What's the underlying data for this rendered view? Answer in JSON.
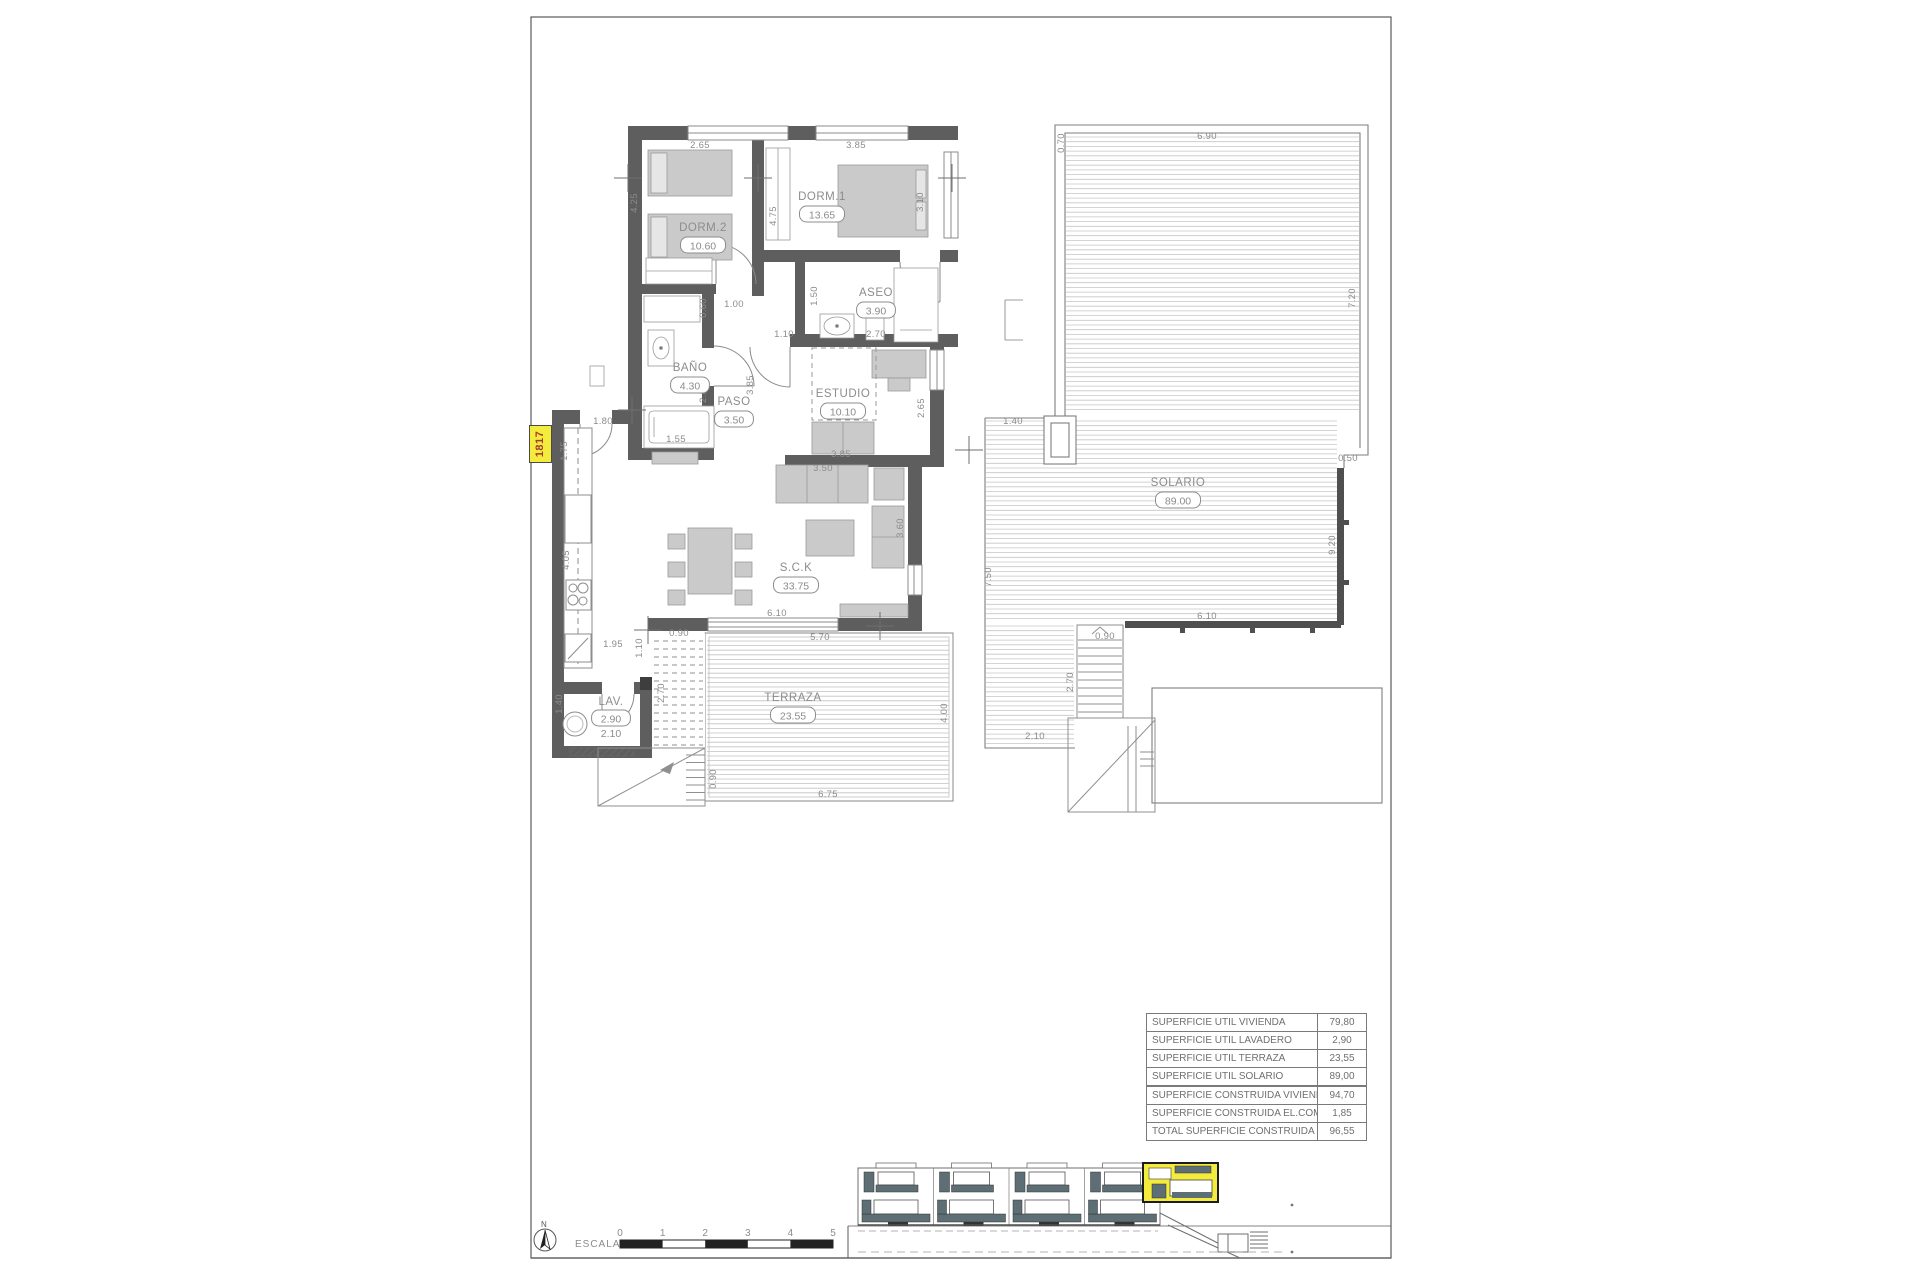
{
  "unit_tag": "1817",
  "colors": {
    "wall": "#5e5e5e",
    "furniture": "#cacaca",
    "deck_line": "#c2c2c2",
    "dim_text": "#8c8c8c",
    "highlight_yellow": "#f3ec3c",
    "tag_text_red": "#a33c2f",
    "railing_slate": "#5d6e74",
    "line_gray": "#7a7a7a"
  },
  "rooms": [
    {
      "name": "DORM.2",
      "area": "10.60",
      "nx": 703,
      "ny": 231,
      "ax": 703,
      "ay": 248
    },
    {
      "name": "DORM.1",
      "area": "13.65",
      "nx": 822,
      "ny": 200,
      "ax": 822,
      "ay": 217
    },
    {
      "name": "ASEO",
      "area": "3.90",
      "nx": 876,
      "ny": 296,
      "ax": 876,
      "ay": 313
    },
    {
      "name": "BAÑO",
      "area": "4.30",
      "nx": 690,
      "ny": 371,
      "ax": 690,
      "ay": 388
    },
    {
      "name": "PASO",
      "area": "3.50",
      "nx": 734,
      "ny": 405,
      "ax": 734,
      "ay": 422
    },
    {
      "name": "ESTUDIO",
      "area": "10.10",
      "nx": 843,
      "ny": 397,
      "ax": 843,
      "ay": 414
    },
    {
      "name": "S.C.K",
      "area": "33.75",
      "nx": 796,
      "ny": 571,
      "ax": 796,
      "ay": 588
    },
    {
      "name": "LAV.",
      "area": "2.90",
      "nx": 611,
      "ny": 705,
      "ax": 611,
      "ay": 721,
      "extra": "2.10",
      "ex": 611,
      "ey": 737
    },
    {
      "name": "TERRAZA",
      "area": "23.55",
      "nx": 793,
      "ny": 701,
      "ax": 793,
      "ay": 718
    },
    {
      "name": "SOLARIO",
      "area": "89.00",
      "nx": 1178,
      "ny": 486,
      "ax": 1178,
      "ay": 503
    }
  ],
  "dims": [
    {
      "t": "2.65",
      "x": 700,
      "y": 148,
      "r": 0
    },
    {
      "t": "3.85",
      "x": 856,
      "y": 148,
      "r": 0
    },
    {
      "t": "4.25",
      "x": 637,
      "y": 203,
      "r": -90
    },
    {
      "t": "4.75",
      "x": 776,
      "y": 216,
      "r": -90
    },
    {
      "t": "3.10",
      "x": 923,
      "y": 202,
      "r": -90
    },
    {
      "t": "1.50",
      "x": 817,
      "y": 296,
      "r": -90
    },
    {
      "t": "2.70",
      "x": 876,
      "y": 337,
      "r": 0
    },
    {
      "t": "0.60",
      "x": 706,
      "y": 308,
      "r": -90
    },
    {
      "t": "1.00",
      "x": 734,
      "y": 307,
      "r": 0
    },
    {
      "t": "1.10",
      "x": 784,
      "y": 337,
      "r": 0
    },
    {
      "t": "3.85",
      "x": 753,
      "y": 385,
      "r": -90
    },
    {
      "t": "2.80",
      "x": 706,
      "y": 393,
      "r": -90
    },
    {
      "t": "1.55",
      "x": 676,
      "y": 442,
      "r": 0
    },
    {
      "t": "1.80",
      "x": 603,
      "y": 424,
      "r": 0
    },
    {
      "t": "1.75",
      "x": 567,
      "y": 451,
      "r": -90
    },
    {
      "t": "4.05",
      "x": 569,
      "y": 560,
      "r": -90
    },
    {
      "t": "1.95",
      "x": 613,
      "y": 647,
      "r": 0
    },
    {
      "t": "1.10",
      "x": 642,
      "y": 648,
      "r": -90
    },
    {
      "t": "0.90",
      "x": 679,
      "y": 636,
      "r": 0
    },
    {
      "t": "1.40",
      "x": 562,
      "y": 704,
      "r": -90
    },
    {
      "t": "2.70",
      "x": 664,
      "y": 693,
      "r": -90
    },
    {
      "t": "0.90",
      "x": 716,
      "y": 779,
      "r": -90
    },
    {
      "t": "6.10",
      "x": 777,
      "y": 616,
      "r": 0
    },
    {
      "t": "5.70",
      "x": 820,
      "y": 640,
      "r": 0
    },
    {
      "t": "4.00",
      "x": 947,
      "y": 713,
      "r": -90
    },
    {
      "t": "6.75",
      "x": 828,
      "y": 797,
      "r": 0
    },
    {
      "t": "3.50",
      "x": 823,
      "y": 471,
      "r": 0
    },
    {
      "t": "3.85",
      "x": 841,
      "y": 457,
      "r": 0
    },
    {
      "t": "2.65",
      "x": 924,
      "y": 408,
      "r": -90
    },
    {
      "t": "3.60",
      "x": 903,
      "y": 528,
      "r": -90
    },
    {
      "t": "0.70",
      "x": 1064,
      "y": 143,
      "r": -90
    },
    {
      "t": "6.90",
      "x": 1207,
      "y": 139,
      "r": 0
    },
    {
      "t": "7.20",
      "x": 1355,
      "y": 298,
      "r": -90
    },
    {
      "t": "1.40",
      "x": 1013,
      "y": 424,
      "r": 0
    },
    {
      "t": "0.50",
      "x": 1348,
      "y": 461,
      "r": 0
    },
    {
      "t": "9.20",
      "x": 1335,
      "y": 545,
      "r": -90
    },
    {
      "t": "7.50",
      "x": 991,
      "y": 577,
      "r": -90
    },
    {
      "t": "6.10",
      "x": 1207,
      "y": 619,
      "r": 0
    },
    {
      "t": "0.90",
      "x": 1105,
      "y": 639,
      "r": 0
    },
    {
      "t": "2.70",
      "x": 1073,
      "y": 682,
      "r": -90
    },
    {
      "t": "2.10",
      "x": 1035,
      "y": 739,
      "r": 0
    }
  ],
  "area_tables": {
    "util_rows": [
      {
        "label": "SUPERFICIE ÚTIL VIVIENDA",
        "value": "79,80"
      },
      {
        "label": "SUPERFICIE ÚTIL LAVADERO",
        "value": "2,90"
      },
      {
        "label": "SUPERFICIE ÚTIL TERRAZA",
        "value": "23,55"
      },
      {
        "label": "SUPERFICIE ÚTIL SOLARIO",
        "value": "89,00"
      }
    ],
    "built_rows": [
      {
        "label": "SUPERFICIE CONSTRUIDA VIVIENDA",
        "value": "94,70"
      },
      {
        "label": "SUPERFICIE CONSTRUIDA EL.COMUNES",
        "value": "1,85"
      },
      {
        "label": "TOTAL SUPERFICIE CONSTRUIDA",
        "value": "96,55"
      }
    ]
  },
  "footer": {
    "north_letter": "N",
    "scale_label": "ESCALA :",
    "scale_ticks": [
      "0",
      "1",
      "2",
      "3",
      "4",
      "5"
    ]
  }
}
